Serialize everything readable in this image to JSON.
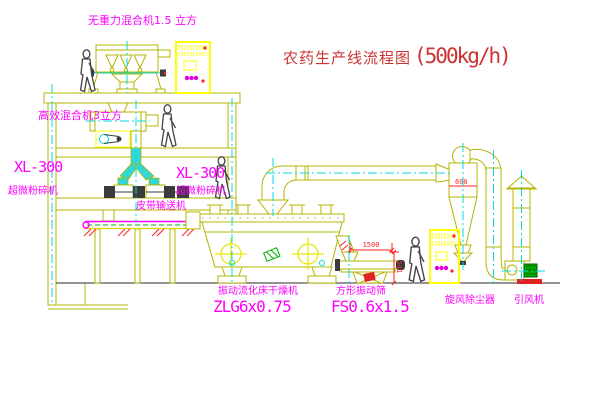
{
  "title": {
    "name": "农药生产线流程图",
    "capacity": "(500kg/h)"
  },
  "equipment_labels": {
    "top_mixer": "无重力混合机1.5 立方",
    "floor2_mixer": "高效混合机3立方",
    "left_mill": {
      "model": "XL-300",
      "name": "超微粉碎机"
    },
    "right_mill": {
      "model": "XL-300",
      "name": "超微粉碎机"
    },
    "belt_conveyor": "皮带输送机",
    "fluid_bed_dryer": {
      "name": "振动流化床干燥机",
      "model": "ZLG6x0.75"
    },
    "vibrating_sieve": {
      "name": "方形振动筛",
      "model": "FS0.6x1.5"
    },
    "cyclone": "旋风除尘器",
    "induced_draft_fan": "引风机"
  },
  "dimensions": {
    "sieve_length": "1500",
    "sieve_height": "541",
    "cyclone_note": "600"
  },
  "colors": {
    "label_magenta": "#ff00ff",
    "title_red": "#cc3333",
    "dimension_red": "#ff2222",
    "structure_olive": "#b4b400",
    "panel_yellow": "#ffff00",
    "centerline_cyan": "#00dcdc",
    "conveyor_green": "#00b400",
    "motor_green": "#00a800",
    "background": "#ffffff"
  }
}
